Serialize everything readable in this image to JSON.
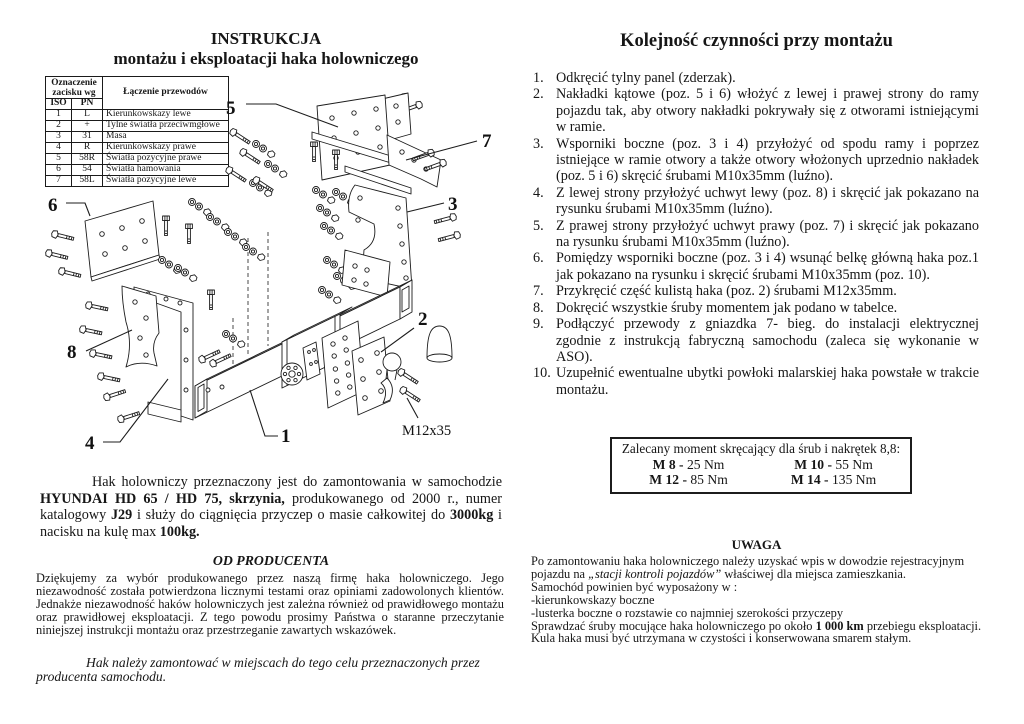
{
  "left_column": {
    "title": "INSTRUKCJA",
    "subtitle": "montażu i eksploatacji haka holowniczego",
    "wiring_table": {
      "col_group_header": "Oznaczenie zacisku wg",
      "col_connection_header": "Łączenie przewodów",
      "col_iso": "ISO",
      "col_pn": "PN",
      "rows": [
        [
          "1",
          "L",
          "Kierunkowskazy lewe"
        ],
        [
          "2",
          "+",
          "Tylne światła przeciwmgłowe"
        ],
        [
          "3",
          "31",
          "Masa"
        ],
        [
          "4",
          "R",
          "Kierunkowskazy prawe"
        ],
        [
          "5",
          "58R",
          "Światła pozycyjne prawe"
        ],
        [
          "6",
          "54",
          "Światła hamowania"
        ],
        [
          "7",
          "58L",
          "Światła pozycyjne lewe"
        ]
      ]
    },
    "diagram": {
      "labels": [
        "1",
        "2",
        "3",
        "4",
        "5",
        "6",
        "7",
        "8"
      ],
      "bolt_label": "M12x35"
    },
    "intro_segments": [
      {
        "t": "Hak holowniczy przeznaczony jest do zamontowania w samochodzie "
      },
      {
        "t": "HYUNDAI HD 65 / HD 75, skrzynia,",
        "b": true
      },
      {
        "t": " produkowanego od 2000 r., numer katalogowy "
      },
      {
        "t": "J29",
        "b": true
      },
      {
        "t": " i służy do ciągnięcia przyczep o masie całkowitej do "
      },
      {
        "t": "3000kg",
        "b": true
      },
      {
        "t": " i nacisku na kulę max "
      },
      {
        "t": "100kg.",
        "b": true
      }
    ],
    "producer": {
      "heading": "OD PRODUCENTA",
      "body": "Dziękujemy za wybór produkowanego przez naszą firmę haka holowniczego. Jego niezawodność została potwierdzona licznymi testami oraz opiniami zadowolonych klientów. Jednakże niezawodność haków holowniczych jest zależna również od prawidłowego montażu oraz prawidłowej eksploatacji. Z tego powodu prosimy Państwa o staranne przeczytanie niniejszej instrukcji montażu oraz przestrzeganie zawartych wskazówek.",
      "note": "Hak należy zamontować w miejscach do tego celu przeznaczonych przez producenta samochodu."
    }
  },
  "right_column": {
    "title": "Kolejność czynności przy montażu",
    "steps": [
      {
        "num": "1.",
        "text": "Odkręcić tylny panel (zderzak)."
      },
      {
        "num": "2.",
        "text": "Nakładki kątowe (poz. 5 i 6) włożyć z lewej i prawej strony do ramy pojazdu tak, aby otwory nakładki pokrywały się z otworami istniejącymi w ramie."
      },
      {
        "num": "3.",
        "text": "Wsporniki boczne (poz. 3 i 4) przyłożyć od spodu ramy i poprzez istniejące w ramie otwory a także otwory włożonych uprzednio nakładek (poz. 5 i 6) skręcić śrubami M10x35mm (luźno)."
      },
      {
        "num": "4.",
        "text": "Z lewej strony przyłożyć uchwyt lewy (poz. 8) i skręcić jak pokazano na rysunku śrubami M10x35mm (luźno)."
      },
      {
        "num": "5.",
        "text": "Z prawej strony przyłożyć uchwyt prawy (poz. 7) i skręcić jak pokazano na rysunku śrubami M10x35mm (luźno)."
      },
      {
        "num": "6.",
        "text": "Pomiędzy wsporniki boczne (poz. 3 i 4) wsunąć belkę główną haka poz.1 jak pokazano na rysunku i skręcić śrubami M10x35mm (poz. 10)."
      },
      {
        "num": "7.",
        "text": "Przykręcić część kulistą haka (poz. 2) śrubami M12x35mm."
      },
      {
        "num": "8.",
        "text": "Dokręcić wszystkie śruby momentem jak podano w tabelce."
      },
      {
        "num": "9.",
        "text": "Podłączyć przewody z gniazdka 7- bieg. do instalacji elektrycznej zgodnie z instrukcją fabryczną samochodu (zaleca się wykonanie  w ASO)."
      },
      {
        "num": "10.",
        "text": "Uzupełnić ewentualne ubytki powłoki malarskiej haka powstałe w trakcie montażu."
      }
    ],
    "torque_box": {
      "title": "Zalecany moment skręcający dla śrub i nakrętek 8,8:",
      "entries": [
        {
          "label": "M 8 -",
          "value": "25 Nm"
        },
        {
          "label": "M 10 -",
          "value": "55 Nm"
        },
        {
          "label": "M 12 -",
          "value": "85 Nm"
        },
        {
          "label": "M 14 -",
          "value": "135 Nm"
        }
      ]
    },
    "uwaga": {
      "heading": "UWAGA",
      "lines": [
        {
          "segments": [
            {
              "t": "Po  zamontowaniu haka holowniczego należy uzyskać wpis w dowodzie rejestracyjnym pojazdu na "
            },
            {
              "t": "„stacji kontroli pojazdów”",
              "i": true
            },
            {
              "t": " właściwej dla miejsca zamieszkania."
            }
          ]
        },
        {
          "segments": [
            {
              "t": "Samochód powinien być wyposażony w :"
            }
          ]
        },
        {
          "segments": [
            {
              "t": "-kierunkowskazy boczne"
            }
          ]
        },
        {
          "segments": [
            {
              "t": "-lusterka boczne  o rozstawie co najmniej szerokości przyczepy"
            }
          ]
        },
        {
          "segments": [
            {
              "t": "Sprawdzać śruby mocujące haka holowniczego po około "
            },
            {
              "t": "1 000 km",
              "b": true
            },
            {
              "t": " przebiegu eksploatacji."
            }
          ]
        },
        {
          "segments": [
            {
              "t": "Kula haka musi być utrzymana w czystości i konserwowana smarem stałym."
            }
          ]
        }
      ]
    }
  }
}
